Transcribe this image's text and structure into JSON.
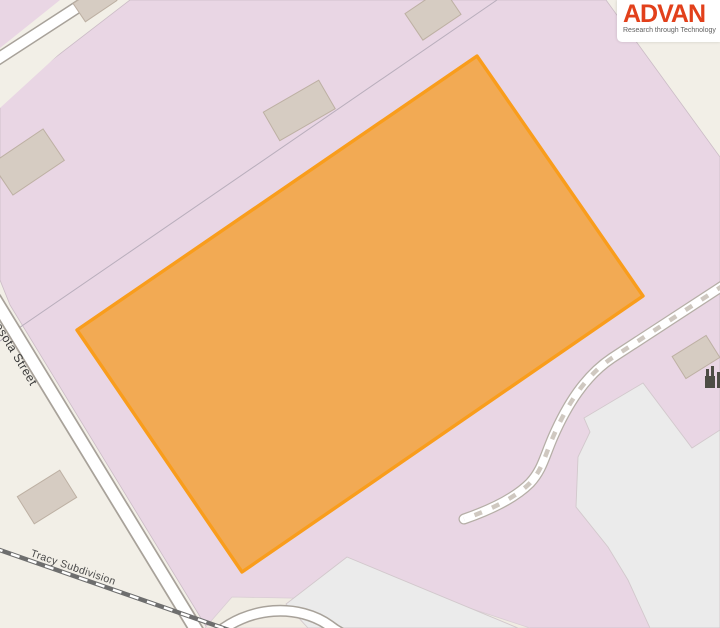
{
  "logo": {
    "title": "ADVAN",
    "tagline": "Research through Technology",
    "title_color": "#e2401b",
    "tagline_color": "#606060"
  },
  "map": {
    "labels": {
      "street": "Minnesota Street",
      "railway": "Tracy Subdivision"
    },
    "icons": {
      "factory": "factory-icon"
    },
    "colors": {
      "land_beige": "#f2efe7",
      "industrial_pink": "#e9d6e4",
      "selection_fill": "#f3a440",
      "selection_stroke": "#f99d1c",
      "building_fill": "#d6ccc2",
      "building_stroke": "#bdb0a3",
      "road_fill": "#ffffff",
      "road_casing": "#a8a29a",
      "track_dash": "#cfc8c0",
      "railway": "#6e6e6e",
      "paved_gray": "#ebebeb",
      "fence_line": "#b9aebc"
    }
  }
}
